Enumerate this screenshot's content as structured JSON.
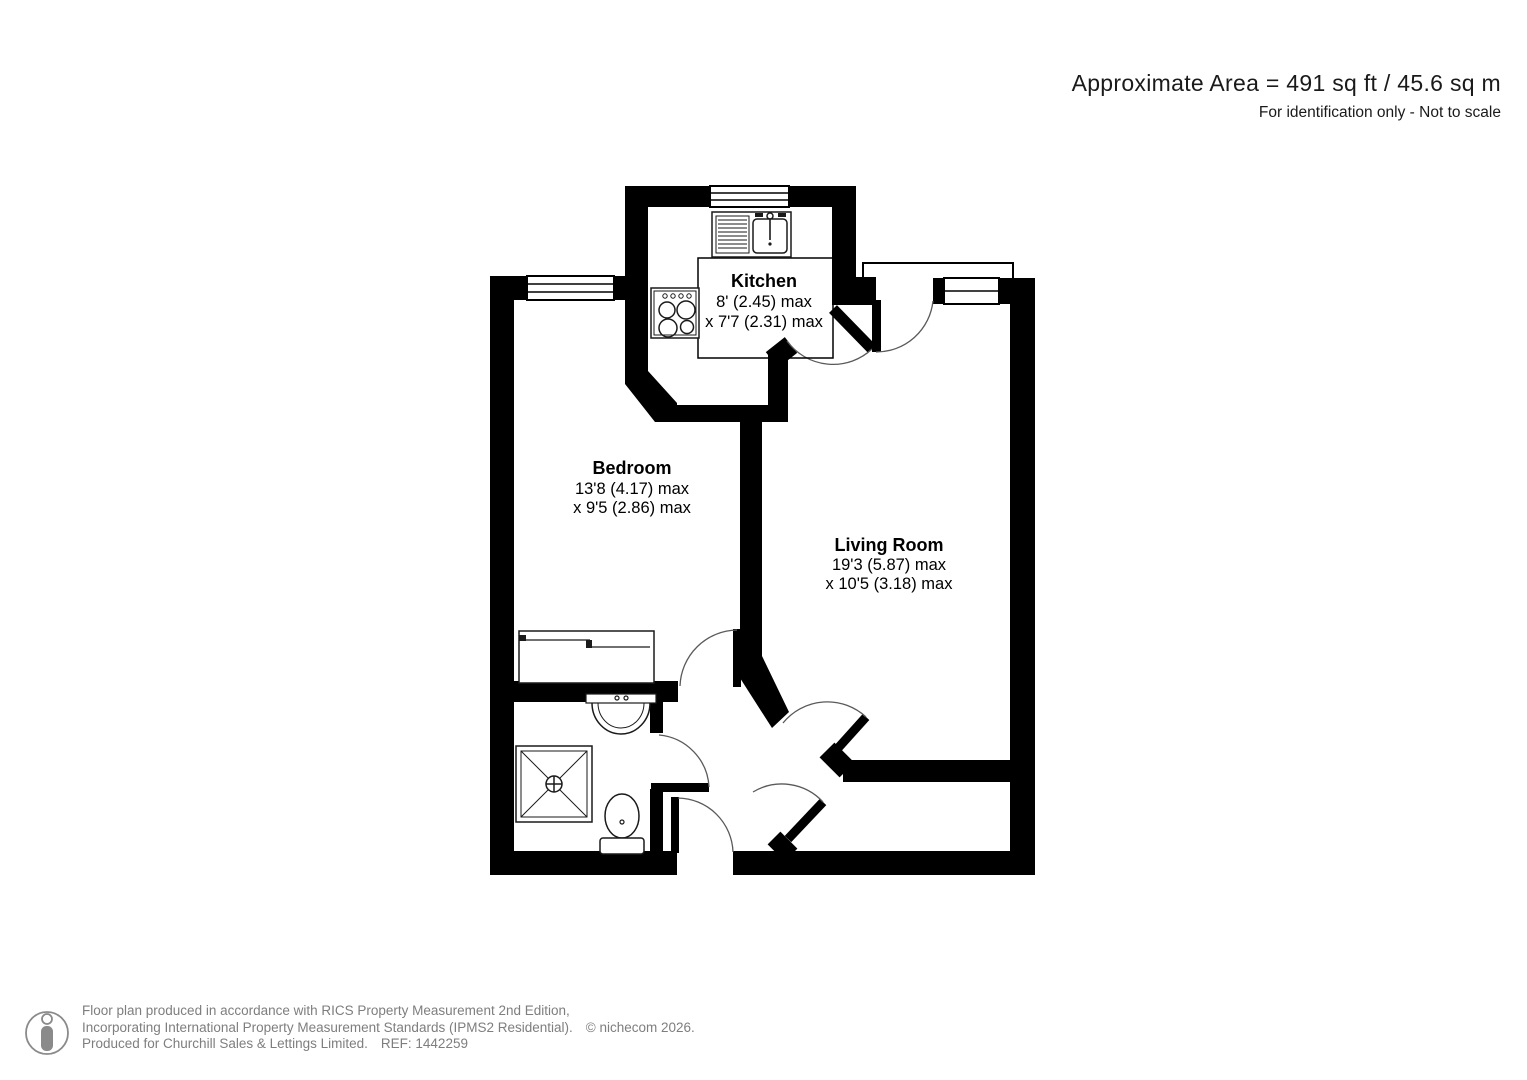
{
  "title": {
    "area": "Approximate Area = 491 sq ft / 45.6 sq m",
    "note": "For identification only - Not to scale"
  },
  "rooms": {
    "kitchen": {
      "name": "Kitchen",
      "dim1": "8' (2.45) max",
      "dim2": "x 7'7 (2.31) max"
    },
    "bedroom": {
      "name": "Bedroom",
      "dim1": "13'8 (4.17) max",
      "dim2": "x 9'5 (2.86) max"
    },
    "living_room": {
      "name": "Living Room",
      "dim1": "19'3 (5.87) max",
      "dim2": "x 10'5 (3.18) max"
    }
  },
  "footer": {
    "line1": "Floor plan produced in accordance with RICS Property Measurement 2nd Edition,",
    "line2": "Incorporating International Property Measurement Standards (IPMS2 Residential).",
    "copyright": "© nichecom 2026.",
    "line3": "Produced for Churchill Sales & Lettings Limited.",
    "ref": "REF: 1442259"
  },
  "colors": {
    "wall": "#000000",
    "door_arc": "#5a5a5a",
    "muted_text": "#7e7e7e"
  }
}
